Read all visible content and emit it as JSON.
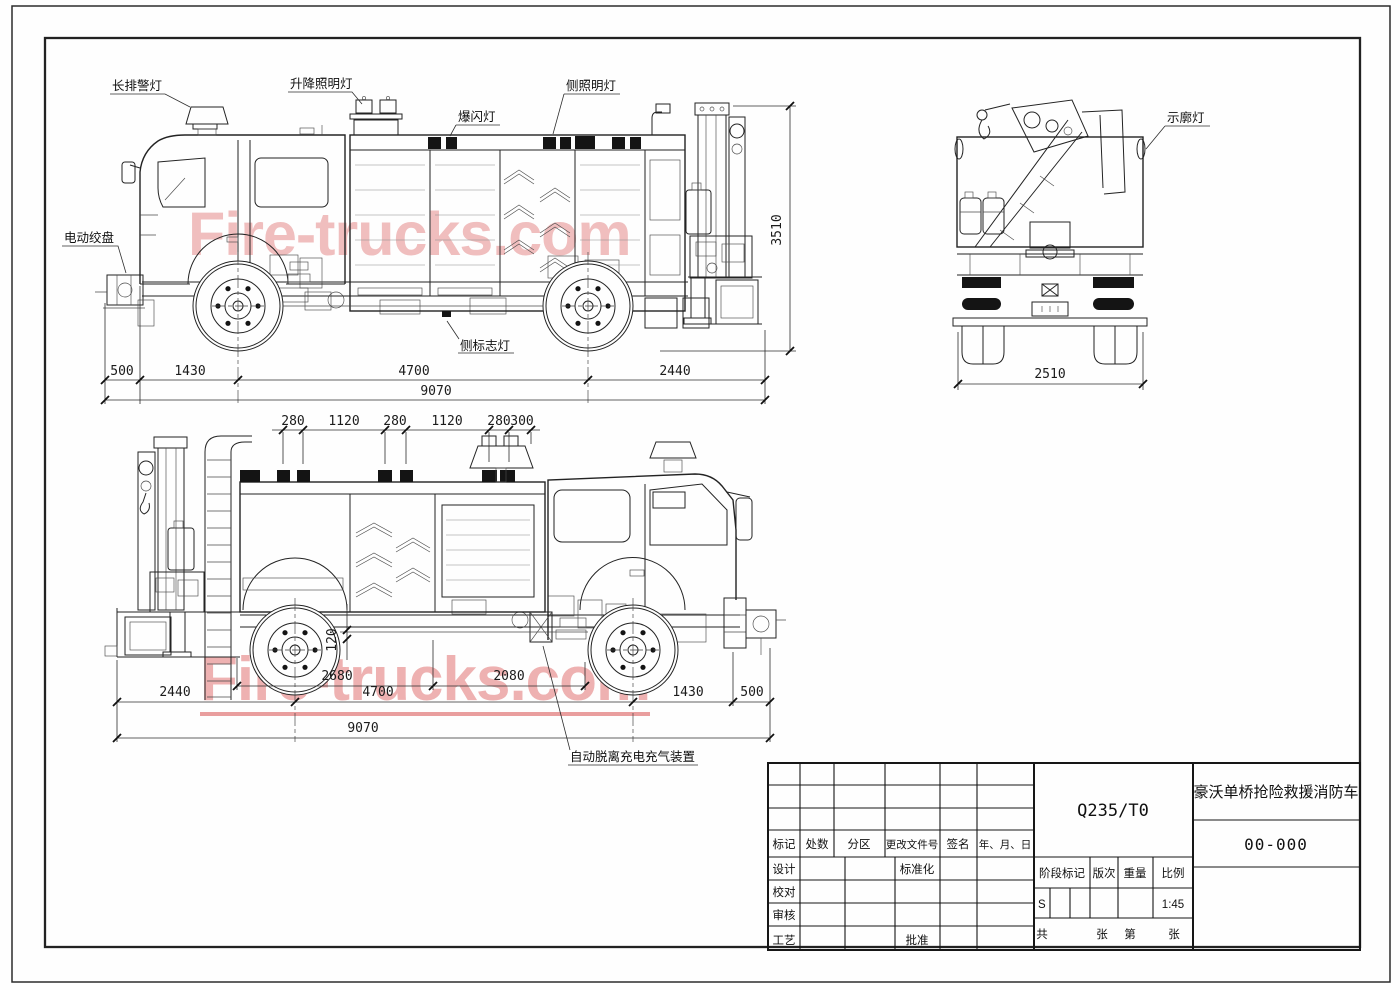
{
  "drawing": {
    "watermark": {
      "text": "Fire-trucks.com",
      "color": "#db5858"
    },
    "callouts": {
      "light_bar": "长排警灯",
      "lift_light": "升降照明灯",
      "strobe": "爆闪灯",
      "side_flood": "侧照明灯",
      "winch": "电动绞盘",
      "side_marker": "侧标志灯",
      "clearance": "示廓灯",
      "auto_charge": "自动脱离充电充气装置"
    },
    "dims_side1": {
      "a": "500",
      "b": "1430",
      "c": "4700",
      "d": "2440",
      "total": "9070",
      "height": "3510"
    },
    "dims_rear": {
      "width": "2510"
    },
    "dims_side2_top": {
      "a": "280",
      "b": "1120",
      "c": "280",
      "d": "1120",
      "e": "280",
      "f": "300"
    },
    "dims_side2": {
      "a": "2440",
      "b": "2680",
      "c": "4700",
      "d": "2080",
      "e": "1430",
      "f": "500",
      "total": "9070",
      "step": "120"
    }
  },
  "title_block": {
    "material": "Q235/T0",
    "product_name": "豪沃单桥抢险救援消防车",
    "drawing_no": "00-000",
    "rev_headers": [
      "标记",
      "处数",
      "分区",
      "更改文件号",
      "签名",
      "年、月、日"
    ],
    "sign_labels": [
      "设计",
      "校对",
      "审核",
      "工艺"
    ],
    "approve_labels": [
      "标准化",
      "批准"
    ],
    "stage_headers": [
      "阶段标记",
      "版次",
      "重量",
      "比例"
    ],
    "stage_mark": "S",
    "scale": "1:45",
    "sheet_labels": [
      "共",
      "张",
      "第",
      "张"
    ]
  }
}
